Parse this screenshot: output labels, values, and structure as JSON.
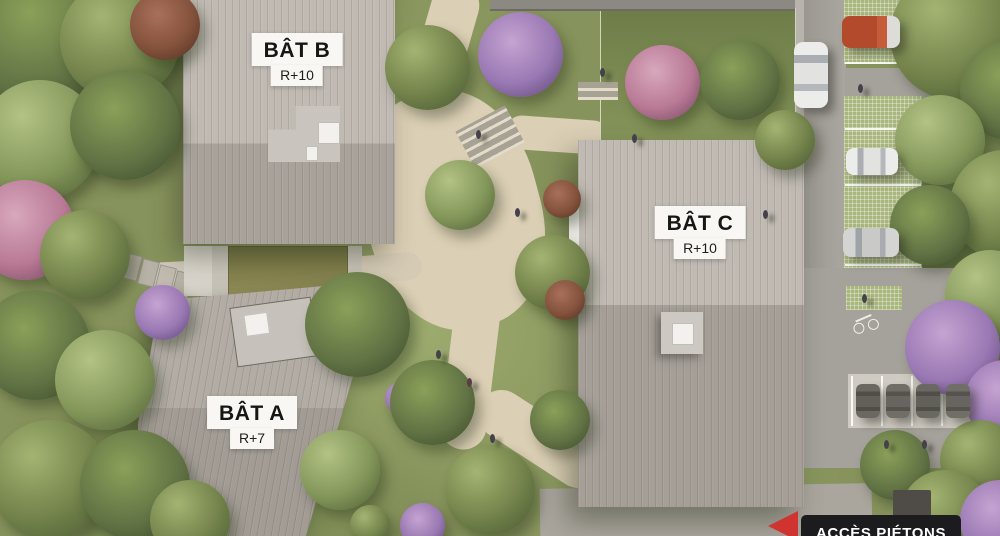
{
  "site": {
    "buildings": [
      {
        "id": "bat-b",
        "label": "BÂT B",
        "height_label": "R+10"
      },
      {
        "id": "bat-c",
        "label": "BÂT C",
        "height_label": "R+10"
      },
      {
        "id": "bat-a",
        "label": "BÂT A",
        "height_label": "R+7"
      }
    ],
    "annotations": {
      "pedestrian_access_label": "ACCÈS PIÉTONS"
    },
    "colors": {
      "roof_light": "#c0bab3",
      "roof_dark": "#a59f98",
      "path_beige": "#dbcfb5",
      "asphalt": "#a5a19b",
      "grass": "#87935c",
      "grass_paver_parking": "#a9b77f",
      "label_background": "#f8f7f3",
      "label_text": "#161616",
      "access_label_background": "#1c1c1e",
      "access_label_text": "#ffffff",
      "access_arrow_red": "#d03430",
      "car_orange": "#b34a2c"
    }
  }
}
